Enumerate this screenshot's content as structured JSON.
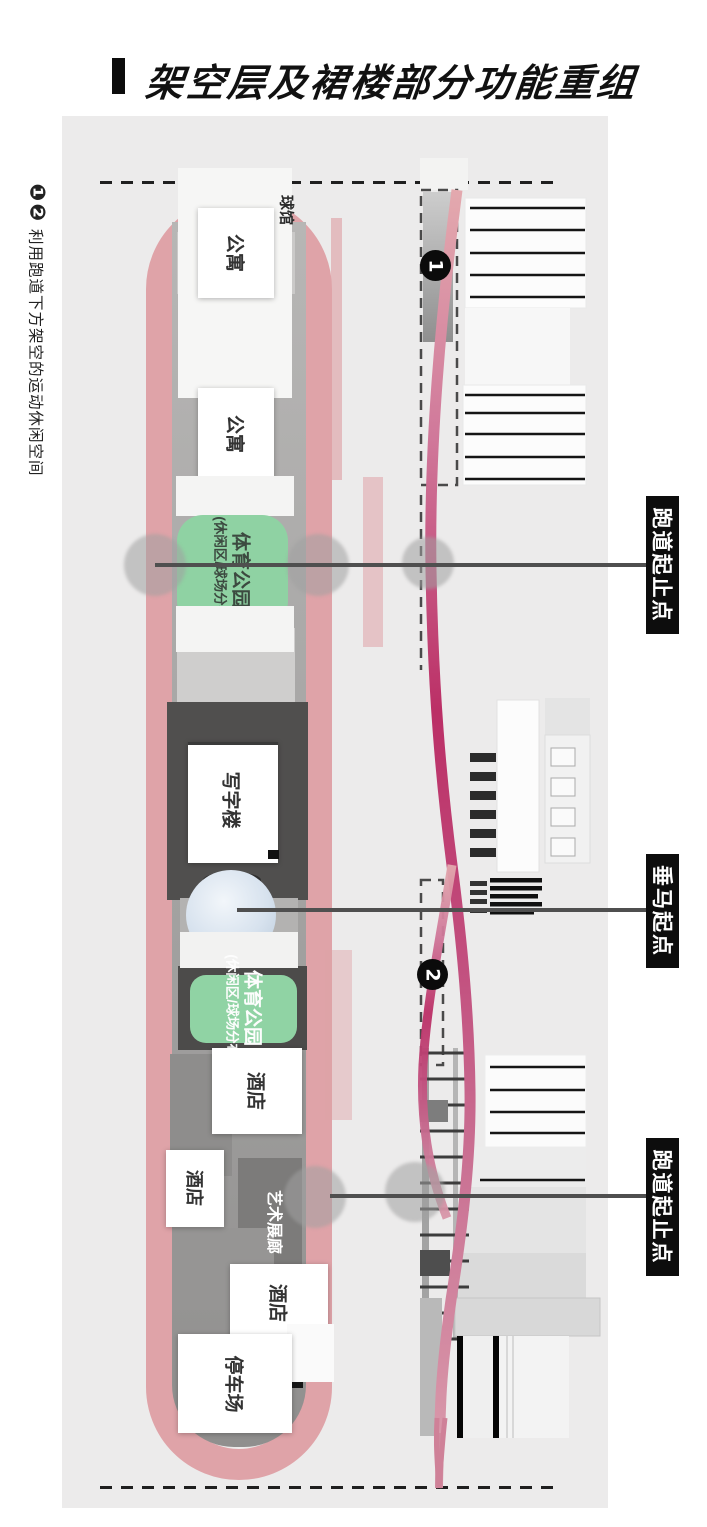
{
  "title": {
    "text": "架空层及裙楼部分功能重组"
  },
  "side_note": {
    "badges": "❶❷",
    "text": "利用跑道下方架空的运动休闲空间"
  },
  "plan": {
    "stadium": "球馆",
    "apartment_1": "公寓",
    "apartment_2": "公寓",
    "sports_park_1": {
      "main": "体育公园",
      "sub": "(休闲区/球场分布)"
    },
    "office": "写字楼",
    "sports_park_2": {
      "main": "体育公园",
      "sub": "(休闲区/球场分布)"
    },
    "hotel_1": "酒店",
    "hotel_2": "酒店",
    "hotel_3": "酒店",
    "art_gallery": "艺术展廊",
    "parking": "停车场"
  },
  "elevation": {
    "badge_1": "1",
    "badge_2": "2"
  },
  "callouts": {
    "top": "跑道起止点",
    "middle": "垂马起点",
    "bottom": "跑道起止点"
  },
  "colors": {
    "track_pink": "#dfa3a8",
    "ribbon_magenta": "#bb2f66",
    "park_green": "#8fd2a3",
    "callout_bg": "#0d0d0d",
    "leader_gray": "#4f4f4f",
    "backdrop_gray": "#ecebeb"
  }
}
